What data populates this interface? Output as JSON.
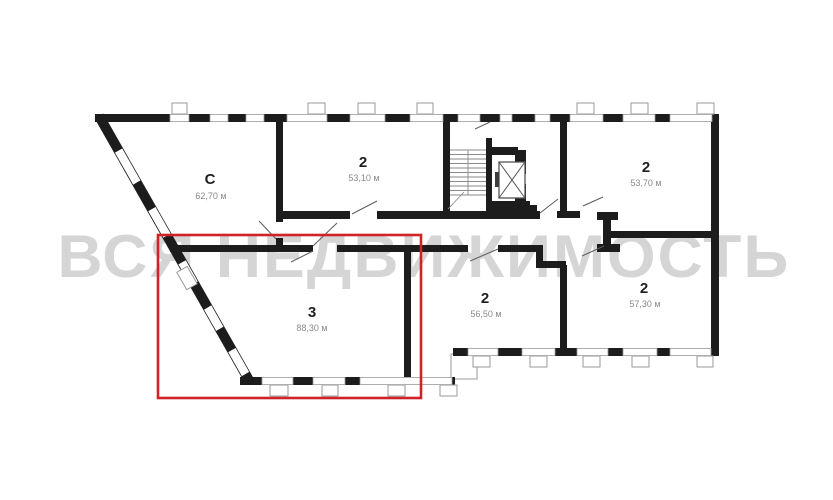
{
  "watermark": "ВСЯ НЕДВИЖИМОСТЬ",
  "colors": {
    "wall": "#1c1c1c",
    "window_frame": "#9a9a9a",
    "door_swing": "#5c5c5c",
    "watermark": "#d5d5d5",
    "highlight": "#cf2329",
    "unit_number": "#1f1f1f",
    "unit_area": "#8a8a8a"
  },
  "floorplan": {
    "units": [
      {
        "number": "C",
        "area": "62,70 м",
        "highlighted": false
      },
      {
        "number": "2",
        "area": "53,10 м",
        "highlighted": false
      },
      {
        "number": "2",
        "area": "53,70 м",
        "highlighted": false
      },
      {
        "number": "3",
        "area": "88,30 м",
        "highlighted": true
      },
      {
        "number": "2",
        "area": "56,50 м",
        "highlighted": false
      },
      {
        "number": "2",
        "area": "57,30 м",
        "highlighted": false
      }
    ],
    "features": [
      "staircase",
      "elevator"
    ]
  }
}
